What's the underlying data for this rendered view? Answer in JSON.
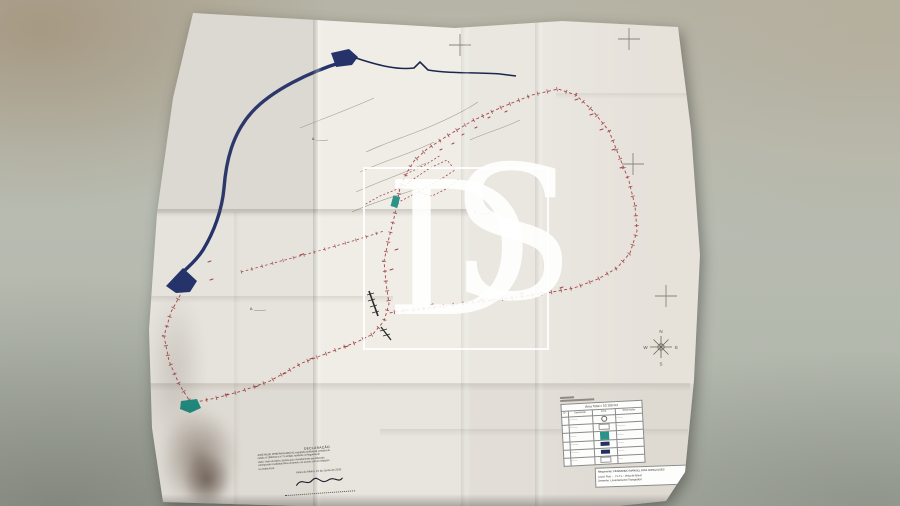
{
  "watermark": {
    "letter_d": "D",
    "letter_s": "S"
  },
  "map": {
    "labels": [
      {
        "text": "A. ______"
      },
      {
        "text": "A. ______"
      },
      {
        "text": "A. ______"
      }
    ],
    "compass": {
      "n": "N",
      "e": "E",
      "s": "S",
      "w": "W"
    },
    "colors": {
      "river_blue": "#26336b",
      "boundary_red": "#a04848",
      "parcel_teal": "#2a9488",
      "pencil_gray": "#8b8577"
    }
  },
  "legend": {
    "area_title": "Área Total = 53 150 m2",
    "columns": [
      "Nº",
      "Designação",
      "Símb.",
      "Observações"
    ],
    "rows": [
      {
        "label": "————",
        "note": "———",
        "swatch_style": "width:4px;height:4px;border:0.5px solid #666;border-radius:50%;background:#fdfdfd"
      },
      {
        "label": "————",
        "note": "————",
        "swatch_style": "background:#ffffff;border:0.4px solid #999"
      },
      {
        "label": "———",
        "note": "———",
        "swatch_style": "background:#2a9488;height:8px"
      },
      {
        "label": "————",
        "note": "———",
        "swatch_style": "background:#23315e"
      },
      {
        "label": "————",
        "note": "———",
        "swatch_style": "background:#23315e"
      },
      {
        "label": "———",
        "note": "——",
        "swatch_style": "background:#ffffff;border:0.4px solid #999"
      }
    ],
    "requerente_line": "Requerente: FERNANDO MANUEL DIAS GONÇALVES",
    "local_line": "Local: Rua … 71-71 – Vista de Baixo",
    "desenho_line": "Desenho: Levantamento Topográfico"
  },
  "declaration": {
    "title": "DECLARAÇÃO",
    "lines": [
      "JOSÉ MILDE PEREIRA RAMALHO, topógrafo profissional, portador da",
      "cédula nº 180/2010 e nº 71 emitida, residente na freguesia de",
      "Vieira, Vieira do Minho, declara que o levantamento que antecede",
      "corresponde à realidade física do terreno, de acordo com as medições",
      "no próprio local."
    ],
    "date_line": "Vieira do Minho, 15 de Junho de 2015"
  }
}
